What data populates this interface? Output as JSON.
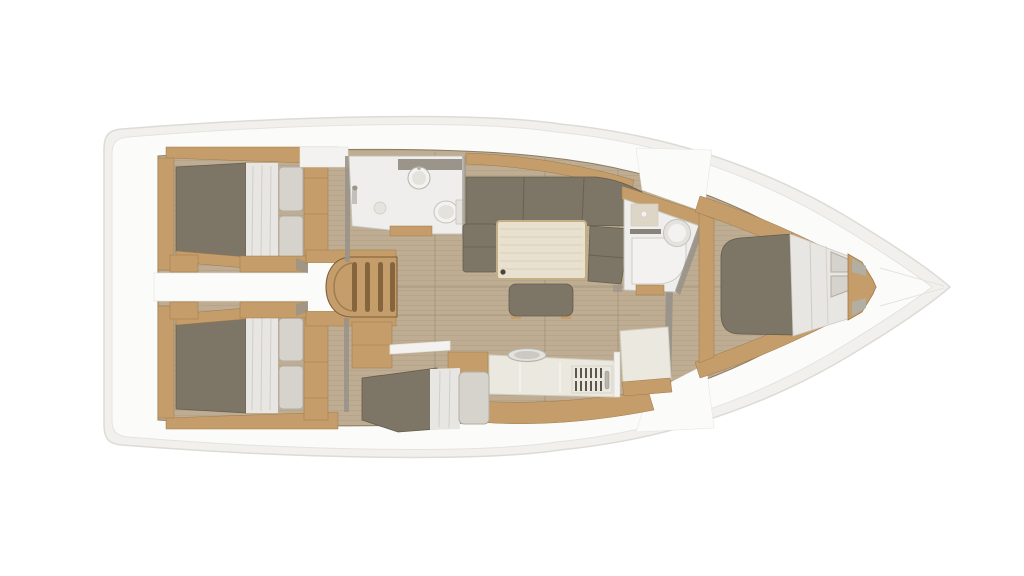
{
  "canvas": {
    "width": 1024,
    "height": 576
  },
  "scene": {
    "type": "sailboat-floor-plan",
    "view": "top-down",
    "areas": [
      "aft-cabin-port",
      "aft-cabin-starboard",
      "companionway",
      "aft-head",
      "salon",
      "galley",
      "mid-berth",
      "chart-table",
      "forward-head",
      "forward-cabin",
      "foredeck",
      "transom"
    ]
  },
  "colors": {
    "background": "#ffffff",
    "hull_shell": "#f1f0ed",
    "hull_line": "#dddbd5",
    "deck": "#fbfbf9",
    "deck_shadow": "#e5e3de",
    "floor": "#bead92",
    "floor_line": "#a6937a",
    "floor_seam": "#8c7c64",
    "wood": "#c49d6b",
    "wood_dark": "#a07a49",
    "wood_deep": "#7b5c36",
    "fabric": "#7d7565",
    "fabric_dark": "#645d4e",
    "sheet": "#e8e6e2",
    "sheet_fold": "#ccc9c2",
    "pillow": "#d6d3cc",
    "pillow_edge": "#b2aea5",
    "bath": "#efeeec",
    "bath_edge": "#c6c3bc",
    "counter": "#ebe8df",
    "counter_edge": "#d3cfc2",
    "table": "#e9e1d0",
    "table_rim": "#c4ae83",
    "table_grain": "#d8cbae",
    "wall": "#9a948a",
    "grill": "#5c564c",
    "metal": "#b7b4ad",
    "pad": "#b3aea3",
    "slot": "#6e685e",
    "sink_beige": "#ddd5c6",
    "white_fixture": "#f3f2f0",
    "fixture_inner": "#e4e2dd",
    "leg_dot": "#4a453c"
  }
}
